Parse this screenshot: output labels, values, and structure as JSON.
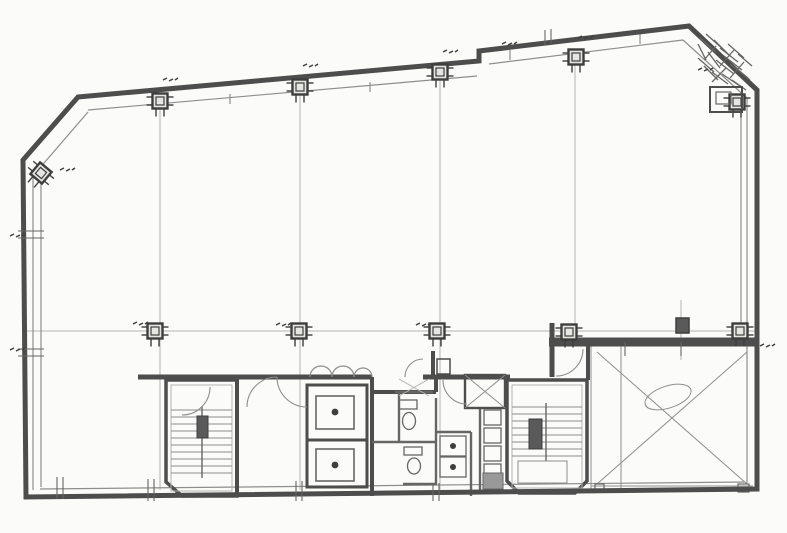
{
  "canvas": {
    "w": 787,
    "h": 533,
    "bg": "#fbfbf9"
  },
  "palette": {
    "wall": "#4d4d4d",
    "mid": "#666666",
    "thin": "#8e8e8e",
    "faint": "#b3b3b3",
    "dark": "#3e3e3e",
    "paper": "#fbfbf9",
    "blob": "#5a5a5a"
  },
  "plan": {
    "outer_wall": {
      "points": [
        [
          78,
          97
        ],
        [
          479,
          61
        ],
        [
          479,
          51
        ],
        [
          689,
          26
        ],
        [
          757,
          90
        ],
        [
          757,
          489
        ],
        [
          26,
          497
        ],
        [
          23,
          160
        ]
      ],
      "width": 5
    },
    "inner_lines": [
      [
        33,
        170,
        33,
        490
      ],
      [
        41,
        172,
        41,
        487
      ],
      [
        38,
        170,
        88,
        112
      ],
      [
        88,
        110,
        477,
        76
      ],
      [
        489,
        64,
        683,
        40
      ],
      [
        683,
        40,
        748,
        99
      ],
      [
        747,
        99,
        747,
        483
      ],
      [
        741,
        99,
        741,
        338
      ],
      [
        40,
        489,
        745,
        482
      ]
    ],
    "grid": {
      "verticals": [
        [
          160,
          106,
          490
        ],
        [
          300,
          92,
          490
        ],
        [
          440,
          78,
          490
        ],
        [
          575,
          64,
          330
        ],
        [
          621,
          345,
          488
        ],
        [
          681,
          300,
          360
        ]
      ],
      "horizontals": [
        [
          26,
          331,
          755,
          331
        ]
      ]
    },
    "columns": {
      "size": 15,
      "top": [
        [
          160,
          101
        ],
        [
          300,
          87
        ],
        [
          440,
          72
        ],
        [
          576,
          57
        ]
      ],
      "mid": [
        [
          155,
          331
        ],
        [
          299,
          331
        ],
        [
          437,
          331
        ],
        [
          569,
          332
        ],
        [
          740,
          331
        ]
      ],
      "corner": [
        {
          "x": 41,
          "y": 173,
          "rot": 40
        },
        {
          "x": 737,
          "y": 102,
          "rot": 0
        }
      ]
    },
    "core_walls": [
      [
        138,
        377,
        372,
        377,
        5
      ],
      [
        372,
        377,
        372,
        392,
        4
      ],
      [
        372,
        392,
        436,
        392,
        3
      ],
      [
        436,
        392,
        436,
        377,
        3
      ],
      [
        423,
        377,
        510,
        377,
        5
      ],
      [
        433,
        351,
        433,
        377,
        4
      ],
      [
        552,
        323,
        552,
        377,
        5
      ],
      [
        549,
        342,
        755,
        342,
        9
      ],
      [
        588,
        344,
        588,
        380,
        4
      ],
      [
        237,
        377,
        237,
        496,
        4
      ],
      [
        372,
        392,
        372,
        496,
        3
      ]
    ],
    "stair_a": {
      "box": [
        [
          166,
          380
        ],
        [
          237,
          380
        ],
        [
          237,
          496
        ],
        [
          182,
          496
        ],
        [
          166,
          482
        ]
      ],
      "inner": [
        171,
        385,
        61,
        106
      ],
      "treads": {
        "x1": 171,
        "x2": 232,
        "y0": 410,
        "step": 7,
        "n": 10
      },
      "rail": [
        202,
        406,
        202,
        478
      ],
      "newel": [
        197,
        416,
        11,
        22
      ]
    },
    "stair_b": {
      "box": [
        [
          507,
          380
        ],
        [
          587,
          380
        ],
        [
          587,
          481
        ],
        [
          575,
          493
        ],
        [
          519,
          493
        ],
        [
          507,
          481
        ]
      ],
      "inner": [
        512,
        385,
        70,
        103
      ],
      "treads": {
        "x1": 512,
        "x2": 582,
        "y0": 407,
        "step": 7,
        "n": 8
      },
      "rail": [
        546,
        403,
        546,
        461
      ],
      "newel": [
        529,
        419,
        13,
        30
      ],
      "landing": [
        518,
        461,
        49,
        22
      ]
    },
    "elevator": {
      "shaft": [
        307,
        385,
        60,
        102
      ],
      "divider_y": 440,
      "cars": [
        [
          316,
          396,
          38,
          33
        ],
        [
          316,
          449,
          38,
          32
        ]
      ],
      "dots": [
        [
          335,
          412
        ],
        [
          335,
          465
        ]
      ]
    },
    "restroom": {
      "partitions": [
        [
          399,
          392,
          399,
          442
        ],
        [
          372,
          442,
          437,
          442
        ],
        [
          436,
          398,
          436,
          484
        ],
        [
          436,
          432,
          471,
          432
        ],
        [
          471,
          432,
          471,
          496
        ],
        [
          403,
          484,
          437,
          484
        ],
        [
          480,
          408,
          480,
          490
        ],
        [
          395,
          392,
          433,
          392
        ]
      ],
      "toilets": [
        {
          "tank": [
            399,
            400,
            18,
            9
          ],
          "bowl": [
            409,
            421,
            6.5,
            8.5
          ]
        },
        {
          "tank": [
            404,
            447,
            18,
            8
          ],
          "bowl": [
            414,
            466,
            6.5,
            8
          ]
        }
      ],
      "sinks": [
        [
          440,
          436,
          26,
          20
        ],
        [
          440,
          457,
          26,
          20
        ]
      ],
      "urinals": [
        [
          484,
          410
        ],
        [
          484,
          428
        ],
        [
          484,
          446
        ],
        [
          484,
          464
        ]
      ],
      "urinal_blob": [
        483,
        473,
        20,
        16
      ],
      "duct_box": [
        465,
        375,
        40,
        33
      ],
      "small_box": [
        437,
        359,
        13,
        15
      ],
      "leaf_lines": [
        [
          399,
          379,
          429,
          396
        ],
        [
          429,
          379,
          399,
          396
        ]
      ]
    },
    "x_room": {
      "left": [
        591,
        345,
        591,
        489
      ],
      "divider": [
        621,
        345,
        621,
        489
      ],
      "bottom": [
        [
          591,
          486,
          753,
          486
        ],
        [
          591,
          491,
          753,
          491
        ]
      ],
      "diagonals": [
        [
          597,
          352,
          747,
          484
        ],
        [
          747,
          352,
          597,
          484
        ]
      ],
      "oval": {
        "cx": 668,
        "cy": 397,
        "rx": 24,
        "ry": 11,
        "rot": -18
      },
      "stub_col": [
        676,
        318,
        13,
        15
      ],
      "tick_boxes": [
        [
          595,
          484,
          9,
          8
        ],
        [
          738,
          484,
          11,
          8
        ]
      ]
    },
    "doors": [
      "M247,407 A30,30 0 0 1 277,377",
      "M277,377 A30,30 0 0 0 307,407",
      "M405,377 A18,18 0 0 1 423,359",
      "M443,380 A24,24 0 0 0 467,404",
      "M583,349 A27,27 0 0 1 556,376",
      "M210,387 A28,28 0 0 1 182,415"
    ],
    "scallops": [
      "M310,377 A11,11 0 0 1 332,377",
      "M332,377 A11,11 0 0 1 354,377",
      "M354,377 A9,9 0 0 1 372,377"
    ],
    "corner_box": {
      "outer": [
        710,
        87,
        32,
        25
      ],
      "inner": [
        716,
        92,
        15,
        12
      ]
    },
    "hatch": [
      [
        700,
        38,
        716,
        52
      ],
      [
        706,
        34,
        724,
        50
      ],
      [
        714,
        40,
        730,
        56
      ],
      [
        720,
        48,
        738,
        62
      ],
      [
        708,
        52,
        720,
        68
      ],
      [
        698,
        58,
        714,
        72
      ],
      [
        716,
        60,
        734,
        74
      ],
      [
        724,
        56,
        742,
        70
      ],
      [
        730,
        64,
        748,
        78
      ],
      [
        704,
        66,
        718,
        80
      ],
      [
        712,
        72,
        728,
        84
      ],
      [
        722,
        74,
        740,
        86
      ],
      [
        732,
        80,
        746,
        90
      ],
      [
        736,
        68,
        750,
        80
      ],
      [
        698,
        44,
        706,
        60
      ],
      [
        728,
        44,
        744,
        58
      ],
      [
        738,
        54,
        752,
        66
      ],
      [
        716,
        46,
        704,
        60
      ],
      [
        734,
        50,
        720,
        66
      ],
      [
        744,
        62,
        730,
        78
      ],
      [
        726,
        68,
        712,
        82
      ]
    ],
    "window_stubs": [
      [
        230,
        94,
        230,
        104
      ],
      [
        370,
        82,
        370,
        92
      ],
      [
        510,
        50,
        510,
        60
      ],
      [
        640,
        34,
        640,
        44
      ]
    ],
    "wall_ticks": [
      [
        18,
        231,
        44,
        231
      ],
      [
        18,
        238,
        44,
        238
      ],
      [
        18,
        349,
        44,
        349
      ],
      [
        18,
        356,
        44,
        356
      ],
      [
        57,
        477,
        57,
        499
      ],
      [
        63,
        477,
        63,
        499
      ],
      [
        148,
        479,
        148,
        501
      ],
      [
        154,
        479,
        154,
        501
      ],
      [
        296,
        481,
        296,
        501
      ],
      [
        302,
        481,
        302,
        501
      ],
      [
        433,
        483,
        433,
        501
      ],
      [
        439,
        483,
        439,
        501
      ],
      [
        545,
        30,
        545,
        45
      ],
      [
        551,
        29,
        551,
        44
      ],
      [
        625,
        342,
        625,
        356
      ],
      [
        681,
        342,
        681,
        356
      ]
    ],
    "marks": [
      [
        163,
        80
      ],
      [
        303,
        66
      ],
      [
        443,
        52
      ],
      [
        502,
        44
      ],
      [
        578,
        38
      ],
      [
        698,
        70
      ],
      [
        133,
        324
      ],
      [
        276,
        325
      ],
      [
        416,
        325
      ],
      [
        10,
        236
      ],
      [
        10,
        350
      ],
      [
        760,
        346
      ],
      [
        60,
        170
      ]
    ]
  }
}
